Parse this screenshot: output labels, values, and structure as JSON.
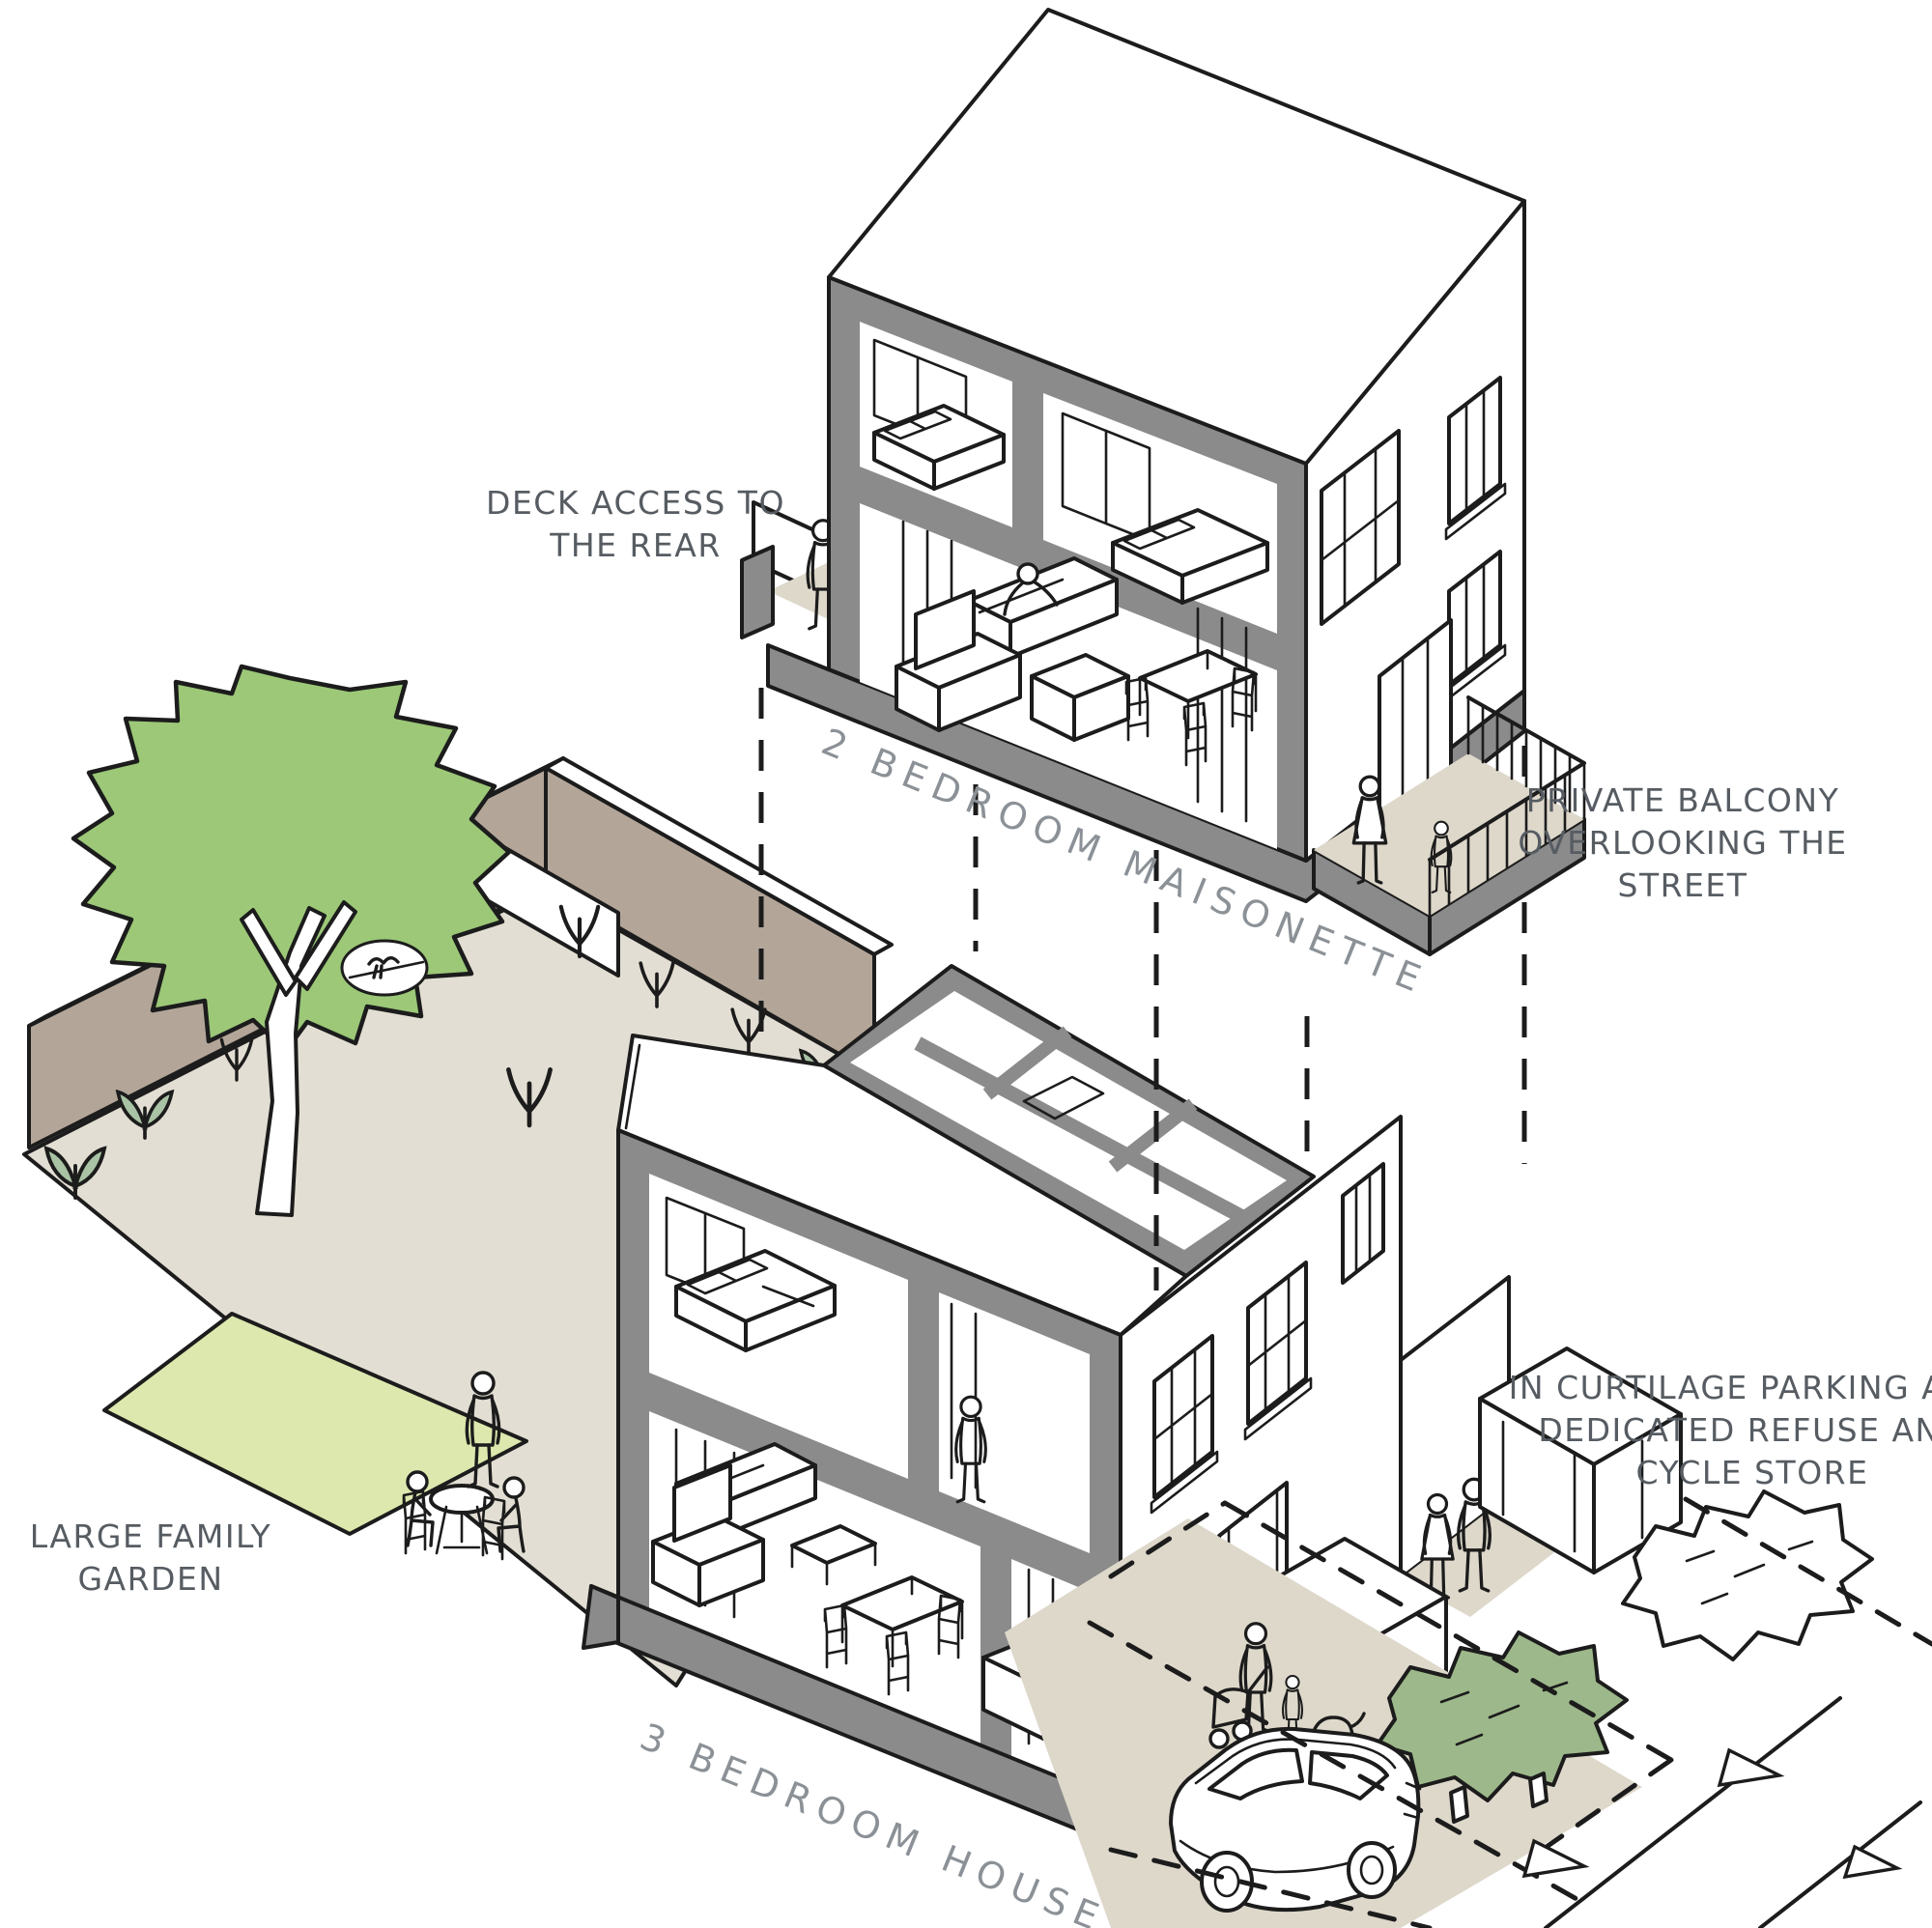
{
  "title": "Housing typology cut-away axonometric diagram",
  "labels": {
    "deck_access": {
      "lines": [
        "DECK ACCESS TO",
        "THE REAR"
      ]
    },
    "maisonette": {
      "text": "2 BEDROOM MAISONETTE"
    },
    "private_balcony": {
      "lines": [
        "PRIVATE BALCONY",
        "OVERLOOKING THE",
        "STREET"
      ]
    },
    "large_family_garden": {
      "lines": [
        "LARGE FAMILY",
        "GARDEN"
      ]
    },
    "curtilage": {
      "lines": [
        "IN CURTILAGE PARKING AND",
        "DEDICATED REFUSE AND",
        "CYCLE STORE"
      ]
    },
    "house": {
      "text": "3 BEDROOM HOUSE"
    }
  },
  "colors": {
    "ink": "#1c1c1c",
    "poche": "#8b8b8b",
    "taupe": "#b3a699",
    "patio": "#e3ded3",
    "ground": "#ded8cb",
    "lawn": "#dce8ad",
    "tree": "#9cc878",
    "hedge": "#9db88a",
    "plant": "#a9c3a4",
    "text": "#565c62",
    "label": "#8b9196",
    "paper": "#ffffff"
  }
}
